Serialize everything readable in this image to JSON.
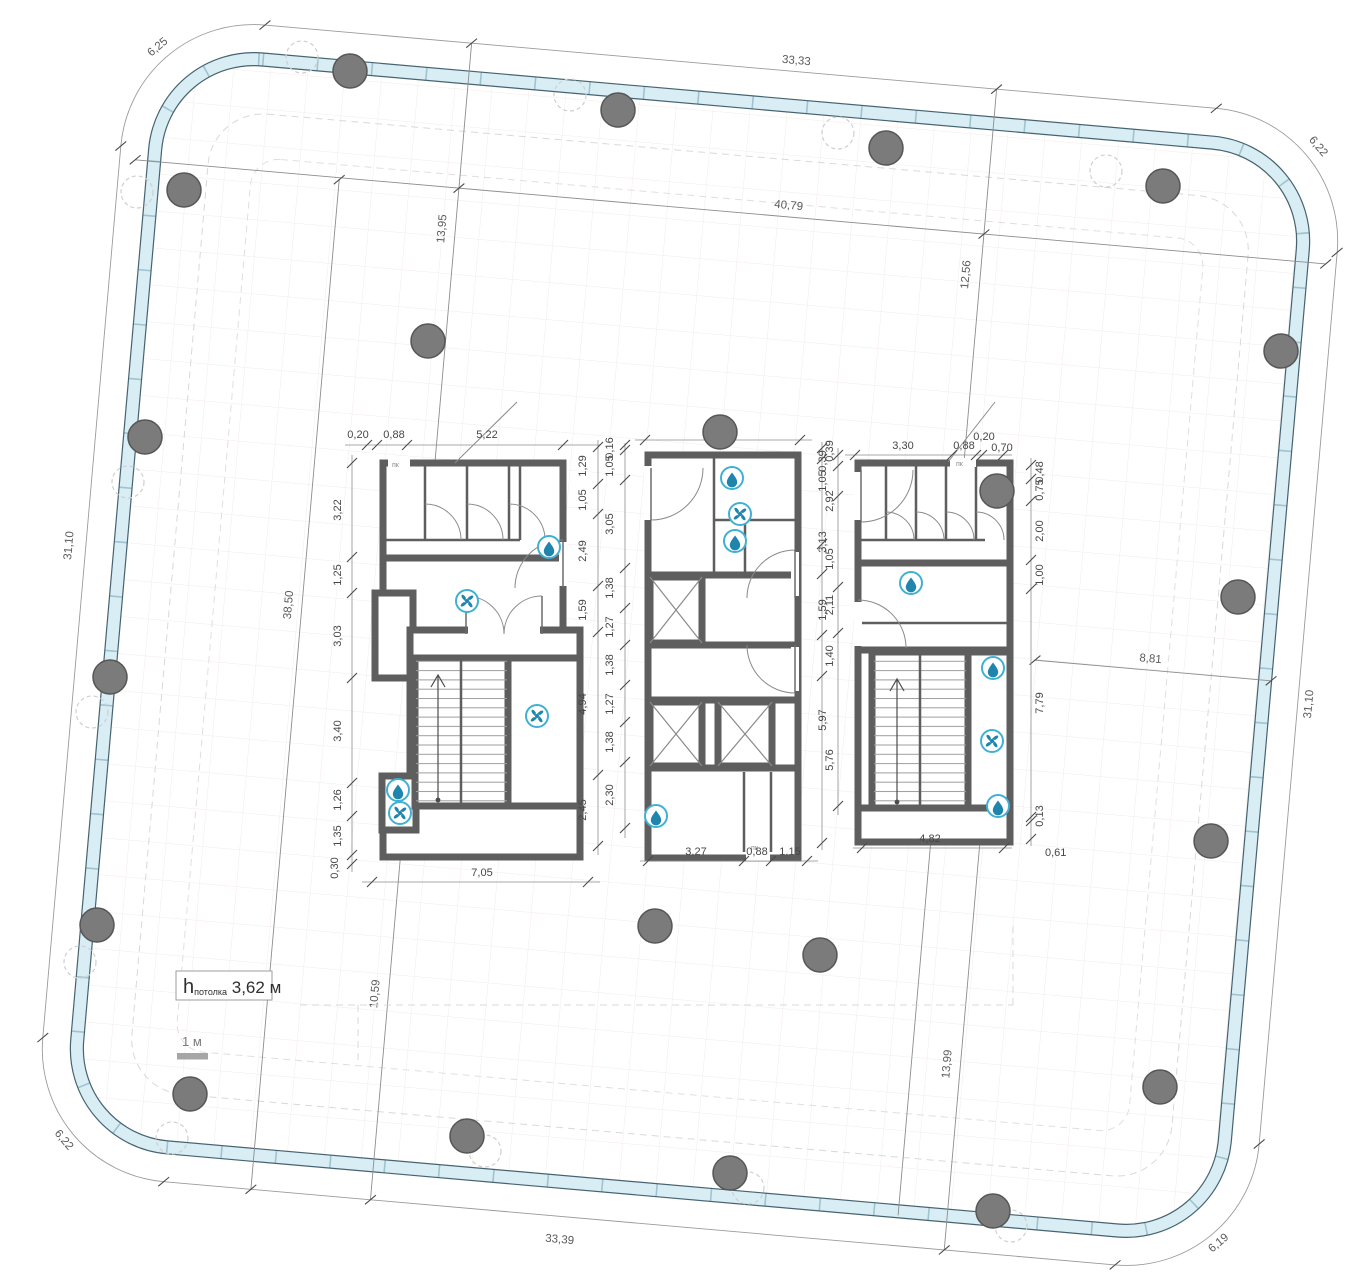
{
  "dims": {
    "perimeter": {
      "top": "33,33",
      "bottom": "33,39",
      "left": "31,10",
      "right": "31,10",
      "corner_tl": "6,25",
      "corner_tr": "6,22",
      "corner_br": "6,19",
      "corner_bl": "6,22"
    },
    "axes": {
      "h1_left": "13,95",
      "h1_mid": "40,79",
      "h1_right": "12,56",
      "v_west": "38,50",
      "v_sw": "10,59",
      "v_se": "13,99",
      "h_east": "8,81"
    },
    "core_a": {
      "top": [
        "0,20",
        "0,88",
        "5,22"
      ],
      "left": [
        "3,22",
        "1,25",
        "3,03",
        "3,40",
        "1,26",
        "1,35",
        "0,30"
      ],
      "right": [
        "1,29",
        "1,05",
        "2,49",
        "1,59",
        "4,94",
        "2,45"
      ],
      "bottom": [
        "7,05"
      ]
    },
    "core_b": {
      "top": [
        "5,30"
      ],
      "left": [
        "0,16",
        "1,05",
        "3,05",
        "1,38",
        "1,27",
        "1,38",
        "1,27",
        "1,38",
        "2,30"
      ],
      "right": [
        "0,39",
        "2,92",
        "1,05",
        "2,11",
        "1,40",
        "5,76"
      ],
      "bottom": [
        "3,27",
        "0,88",
        "1,15"
      ]
    },
    "core_c": {
      "top": [
        "3,30",
        "0,88",
        "0,20",
        "0,70"
      ],
      "left": [
        "0,39",
        "1,05",
        "3,13",
        "1,59",
        "5,97"
      ],
      "right": [
        "0,48",
        "0,75",
        "2,00",
        "1,00",
        "7,79",
        "0,13"
      ],
      "bottom": [
        "4,82",
        "0,61"
      ]
    }
  },
  "annotations": {
    "ceiling_prefix": "h",
    "ceiling_sub": "потолка",
    "ceiling_value": " 3,62 м",
    "scale_label": "1 м",
    "hose_cabinet": "пк"
  },
  "colors": {
    "facade_glass": "#d9edf5",
    "facade_edge": "#46636f",
    "wall": "#5e5e5e",
    "column": "#7b7b7b",
    "icon_accent": "#3fb0d4",
    "icon_glyph": "#1f85ad",
    "grid": "#f3ebeb",
    "dim_text": "#474747"
  },
  "plan": {
    "columns": [
      [
        350,
        71
      ],
      [
        618,
        110
      ],
      [
        886,
        148
      ],
      [
        1163,
        186
      ],
      [
        184,
        190
      ],
      [
        428,
        341
      ],
      [
        1281,
        351
      ],
      [
        145,
        437
      ],
      [
        720,
        432
      ],
      [
        997,
        491
      ],
      [
        1238,
        597
      ],
      [
        110,
        677
      ],
      [
        1211,
        841
      ],
      [
        97,
        925
      ],
      [
        655,
        926
      ],
      [
        820,
        955
      ],
      [
        1160,
        1087
      ],
      [
        190,
        1094
      ],
      [
        467,
        1136
      ],
      [
        730,
        1173
      ],
      [
        993,
        1211
      ]
    ],
    "ghost_columns": [
      [
        302,
        57
      ],
      [
        570,
        95
      ],
      [
        838,
        133
      ],
      [
        1106,
        171
      ],
      [
        137,
        192
      ],
      [
        128,
        482
      ],
      [
        92,
        712
      ],
      [
        80,
        962
      ],
      [
        172,
        1138
      ],
      [
        485,
        1151
      ],
      [
        748,
        1188
      ],
      [
        1011,
        1226
      ]
    ],
    "icons": [
      [
        "drop",
        549,
        547
      ],
      [
        "fan",
        467,
        601
      ],
      [
        "fan",
        537,
        716
      ],
      [
        "drop",
        398,
        790
      ],
      [
        "fan",
        400,
        813
      ],
      [
        "drop",
        732,
        478
      ],
      [
        "fan",
        740,
        514
      ],
      [
        "drop",
        735,
        541
      ],
      [
        "drop",
        656,
        816
      ],
      [
        "drop",
        911,
        583
      ],
      [
        "drop",
        993,
        668
      ],
      [
        "fan",
        992,
        741
      ],
      [
        "drop",
        998,
        806
      ]
    ]
  }
}
